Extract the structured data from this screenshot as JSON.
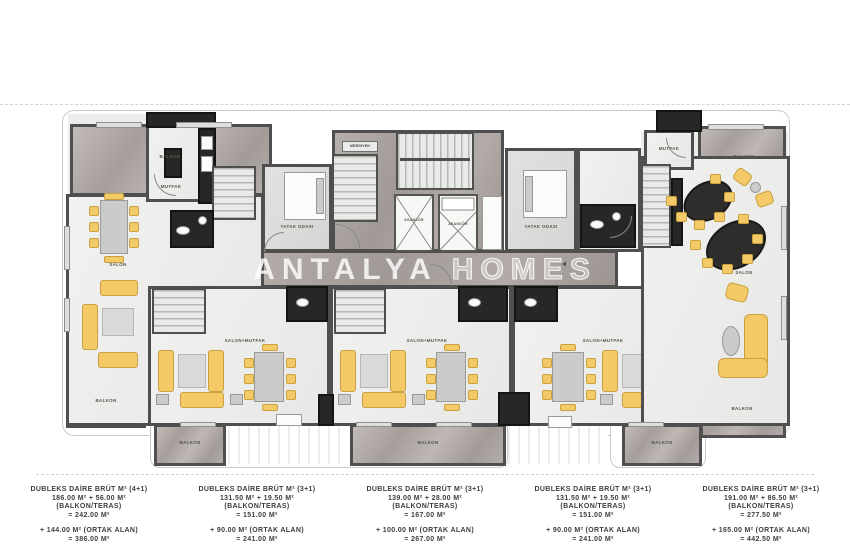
{
  "watermark": {
    "part1": "ANTALYA",
    "part2": "HOMES"
  },
  "plan_labels": {
    "balkon": "BALKON",
    "salon": "SALON",
    "mutfak": "MUTFAK",
    "salon_mutfak": "SALON+MUTFAK",
    "yatak_odasi": "YATAK ODASI",
    "merdiven": "MERDİVEN",
    "asansor": "ASANSÖR"
  },
  "units": [
    {
      "title": "DUBLEKS DAİRE BRÜT M² (4+1)",
      "area_line": "186.00 M² + 56.00 M²",
      "balcony_note": "(BALKON/TERAS)",
      "subtotal": "= 242.00 M²",
      "common_line": "+ 144.00 M² (ORTAK ALAN)",
      "total": "= 386.00 M²"
    },
    {
      "title": "DUBLEKS DAİRE BRÜT M² (3+1)",
      "area_line": "131.50 M² + 19.50 M²",
      "balcony_note": "(BALKON/TERAS)",
      "subtotal": "= 151.00 M²",
      "common_line": "+ 90.00 M² (ORTAK ALAN)",
      "total": "= 241.00 M²"
    },
    {
      "title": "DUBLEKS DAİRE BRÜT M² (3+1)",
      "area_line": "139.00 M² + 28.00 M²",
      "balcony_note": "(BALKON/TERAS)",
      "subtotal": "= 167.00 M²",
      "common_line": "+ 100.00 M² (ORTAK ALAN)",
      "total": "= 267.00 M²"
    },
    {
      "title": "DUBLEKS DAİRE BRÜT M² (3+1)",
      "area_line": "131.50 M² + 19.50 M²",
      "balcony_note": "(BALKON/TERAS)",
      "subtotal": "= 151.00 M²",
      "common_line": "+ 90.00 M² (ORTAK ALAN)",
      "total": "= 241.00 M²"
    },
    {
      "title": "DUBLEKS DAİRE BRÜT M² (3+1)",
      "area_line": "191.00 M² + 86.50 M²",
      "balcony_note": "(BALKON/TERAS)",
      "subtotal": "= 277.50 M²",
      "common_line": "+ 165.00 M² (ORTAK ALAN)",
      "total": "= 442.50 M²"
    }
  ],
  "colors": {
    "furniture_yellow": "#f3ca67",
    "wall_dark": "#4f4f4f",
    "marble_grey": "#aea7a3",
    "floor_light": "#ececea",
    "fixture_dark": "#272725"
  }
}
